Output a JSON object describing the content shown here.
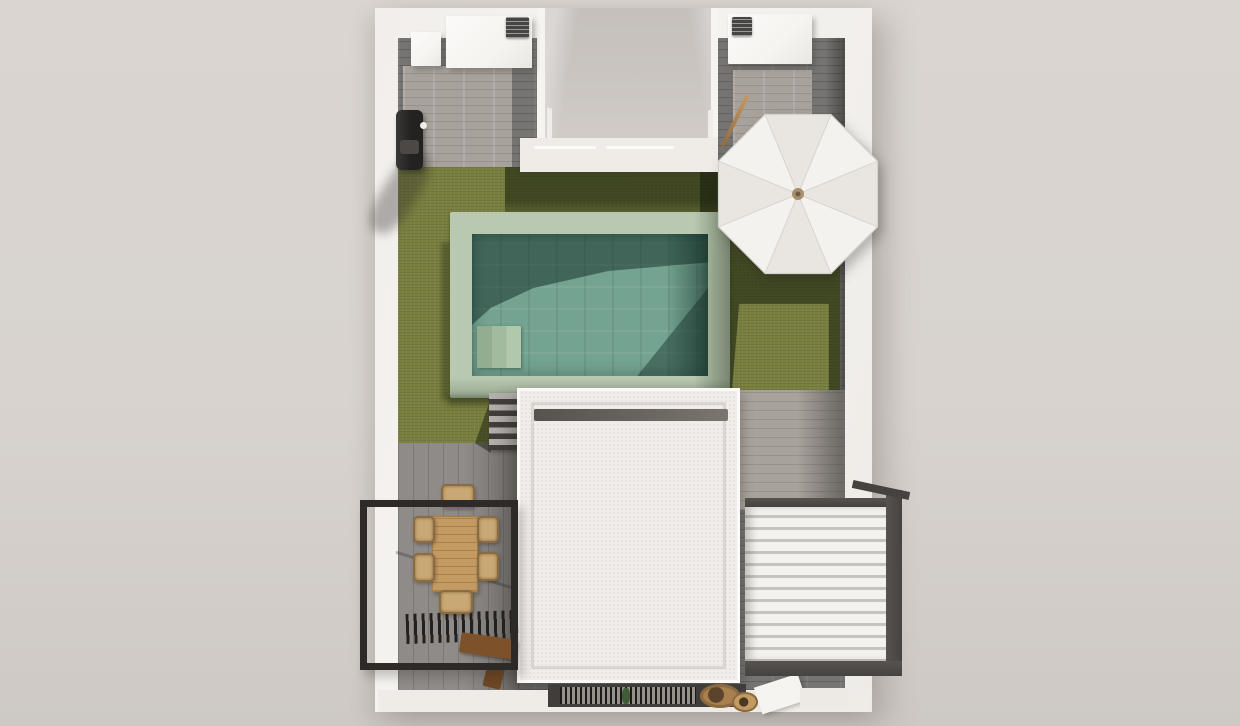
{
  "scene": {
    "title": "Villa plot – 3D top view render",
    "description": "Top-down 3D architectural rendering of a walled villa plot with swimming pool, olive lawn, white octagonal parasol, stone plank patios, white flat roof, dining terrace with black steel frame, louvered pergola and entrance grate",
    "objects": [
      {
        "name": "perimeter-wall",
        "label": "White perimeter wall"
      },
      {
        "name": "entry-courtyard",
        "label": "Recessed entry courtyard between two roof blocks"
      },
      {
        "name": "roof-block-left",
        "label": "White roof block with AC unit"
      },
      {
        "name": "roof-block-right",
        "label": "White roof block with AC unit"
      },
      {
        "name": "stone-patio",
        "label": "Grey plank stone patio"
      },
      {
        "name": "lawn",
        "label": "Olive green lawn"
      },
      {
        "name": "swimming-pool",
        "label": "Rectangular pool with sage coping and teal tiled water"
      },
      {
        "name": "pool-steps",
        "label": "Corner entry steps inside pool"
      },
      {
        "name": "parasol",
        "label": "White octagonal parasol seen from above"
      },
      {
        "name": "garden-shower",
        "label": "Black wall-mounted outdoor shower"
      },
      {
        "name": "main-roof",
        "label": "White textured flat roof with parapet"
      },
      {
        "name": "garden-stairs",
        "label": "Grey garden steps beside the roof"
      },
      {
        "name": "dining-terrace",
        "label": "Dining terrace with wooden table and six wicker chairs"
      },
      {
        "name": "balcony-frame",
        "label": "Black steel balcony frame"
      },
      {
        "name": "dark-louver-grate",
        "label": "Dark slatted louver over the terrace"
      },
      {
        "name": "louvered-pergola",
        "label": "White louvered pergola with dark steel frame"
      },
      {
        "name": "entrance-grate",
        "label": "Fine dark slatted entrance grate"
      },
      {
        "name": "hanging-chairs",
        "label": "Rattan seats near the entrance"
      },
      {
        "name": "broom",
        "label": "Wooden broom leaning on the patio"
      }
    ]
  },
  "colors": {
    "c-bg": "#d8d3cf",
    "c-wall": "#f6f4f1",
    "c-wall-shade": "#e9e5e1",
    "c-plank-dark": "#767472",
    "c-plank-light": "#a8a29c",
    "c-grass": "#79803f",
    "c-coping": "#b9c8b0",
    "c-water": "#74a391",
    "c-roof": "#efece9",
    "c-roof-strip": "#56524e",
    "c-deck": "#8f8b88",
    "c-frame": "#2d2a27",
    "c-metal": "#454240",
    "c-wood": "#c49a63",
    "c-wood-dark": "#7d5129",
    "c-wicker": "#c9a873",
    "c-slat": "#f4f2ef",
    "c-slat-gap": "#c7c3bf",
    "c-grate": "#1d1b19",
    "c-umbrella": "#f4f2ef",
    "c-umbrella-shade": "#e9e6e1",
    "c-hub": "#a98e6c",
    "c-ac": "#464544",
    "c-band": "#efece8",
    "c-notch": "#cac5c1"
  }
}
